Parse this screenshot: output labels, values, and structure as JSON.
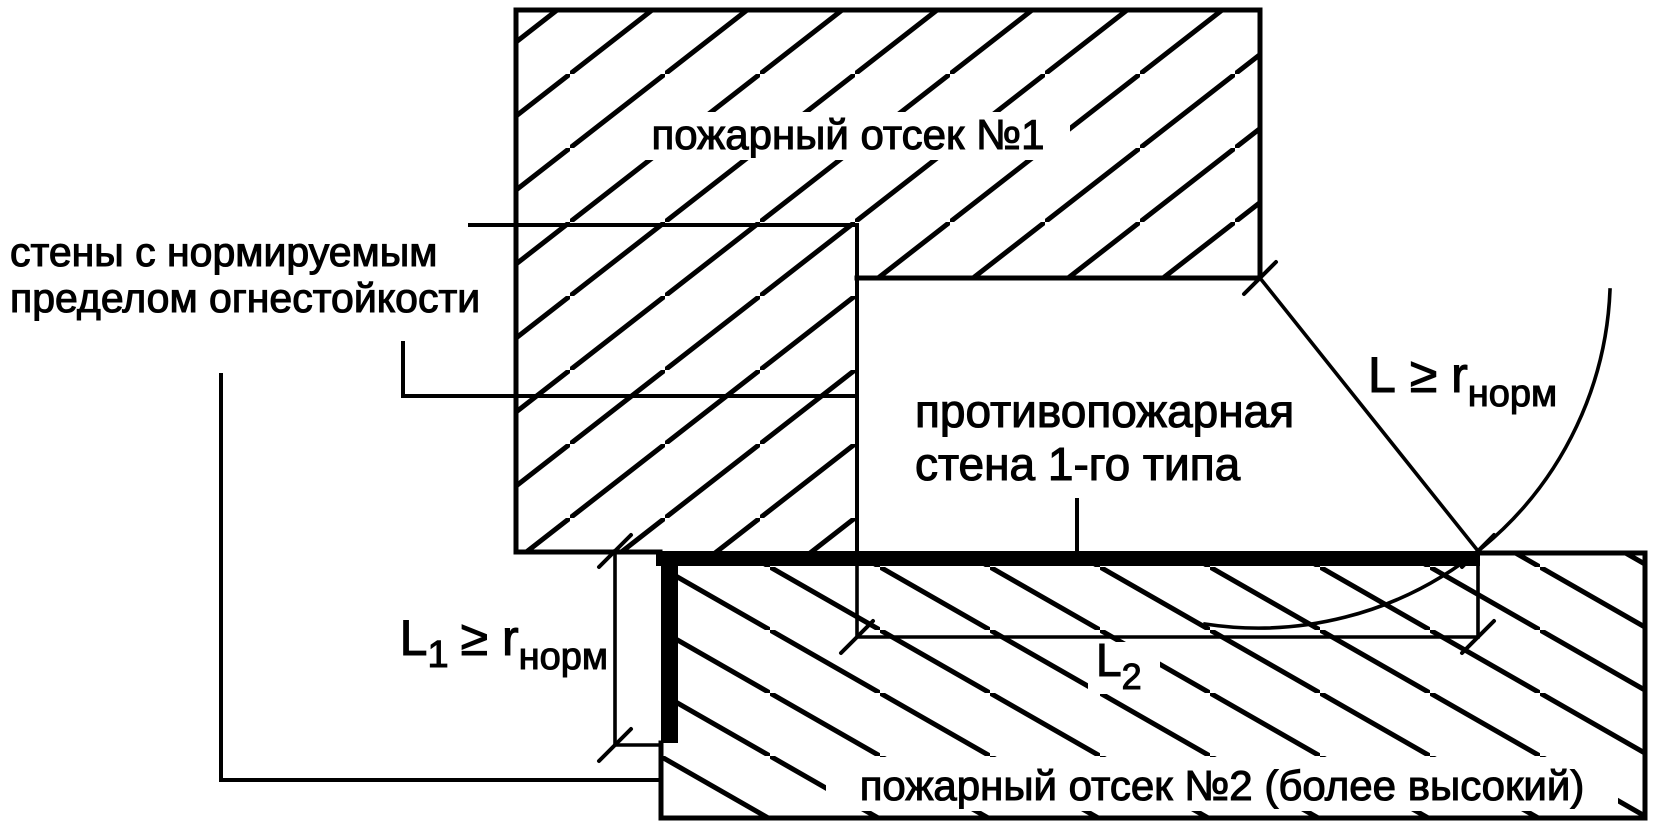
{
  "diagram": {
    "compartment1": {
      "label": "пожарный отсек №1"
    },
    "compartment2": {
      "label": "пожарный отсек №2 (более высокий)"
    },
    "walls_label": {
      "line1": "стены с нормируемым",
      "line2": "пределом огнестойкости"
    },
    "firewall_label": {
      "line1": "противопожарная",
      "line2": "стена 1-го типа"
    },
    "dim_l": {
      "main": "L",
      "mid": "≥ r",
      "sub": "норм"
    },
    "dim_l1": {
      "main": "L",
      "sub1": "1",
      "mid": "≥ r",
      "sub2": "норм"
    },
    "dim_l2": {
      "main": "L",
      "sub1": "2"
    },
    "colors": {
      "ink": "#000000",
      "paper": "#ffffff"
    }
  }
}
